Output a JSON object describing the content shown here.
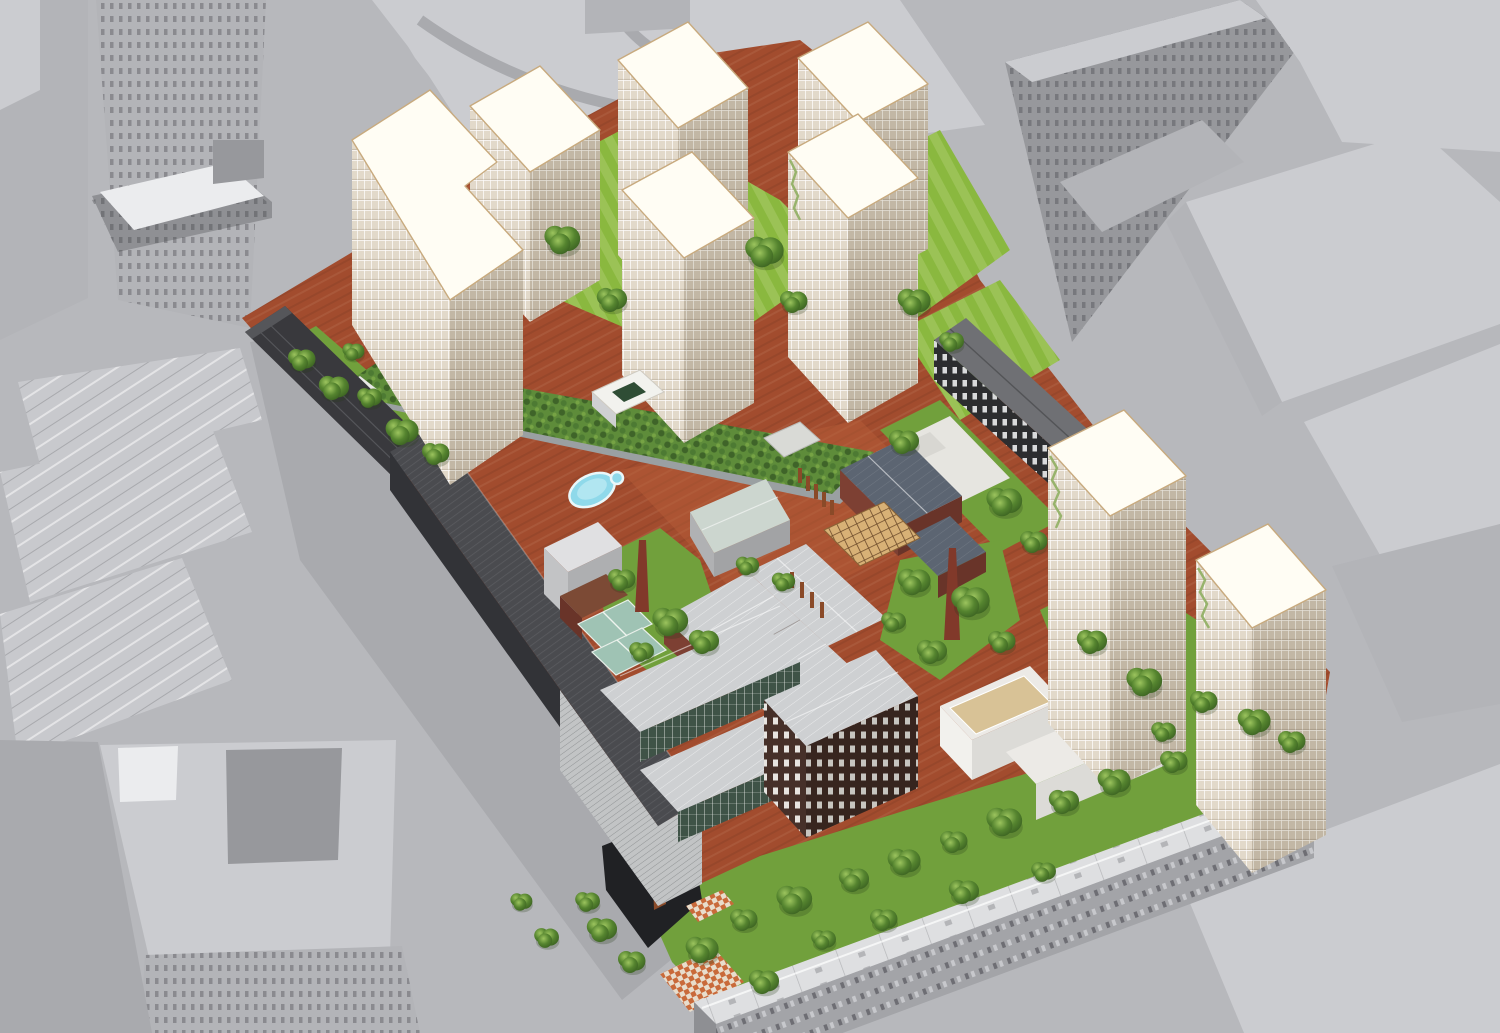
{
  "scene": {
    "type": "architectural-aerial-rendering",
    "title": "Bird's-eye 3D visualization of an urban block redevelopment masterplan",
    "description": "Perspective aerial render of a former industrial block transformed into a mixed-use quarter: seven cream residential towers with glowing white roofs on the north side, two cream towers on the east, red clay ground plane, linear green roof with kidney-shaped pool, preserved brick factory halls with two slender brick chimneys, a timber pergola court, long charcoal bar buildings on the west and north-east edges, a dark perforated cube, white terraced courtyard building, dense tree gardens, and an existing gray perimeter housing row on the south. Surrounding city context is rendered as flat monochrome gray massing with streets.",
    "counts": {
      "towers_north_cluster": 7,
      "towers_east_pair": 2,
      "brick_chimneys": 2,
      "dark_bar_buildings": 3,
      "pools": 1
    },
    "palette": {
      "bg_street": "#b7b8bc",
      "street_dark": "#a9aaae",
      "context_block_light": "#cbccd0",
      "context_block_mid": "#b3b4b8",
      "context_block_dark": "#97989c",
      "context_roof_white": "#ebecee",
      "context_facade": "#8f9094",
      "site_clay": "#a24c2e",
      "site_clay_light": "#b85f3a",
      "lawn_green": "#8ab83f",
      "garden_green": "#71a03c",
      "podium_green": "#5e8c3a",
      "podium_wall": "#9aa0a2",
      "hedge_dark": "#3f6429",
      "pool_blue": "#8fd9ea",
      "pool_rim": "#eaf7f9",
      "tower_face_light": "#e2d9ca",
      "tower_face_shade": "#c2b7a5",
      "tower_roof": "#fffdf4",
      "tower_trim": "#c8aa7e",
      "balcony_green": "#8fae62",
      "dark_shed": "#39393d",
      "dark_bar_roof": "#4a4b4f",
      "dark_bar_face": "#323337",
      "black_bldg_face": "#2c2d2f",
      "black_bldg_roof": "#6f7074",
      "brown_bldg_face": "#463029",
      "brick_red": "#7d4033",
      "slate_roof": "#5c6572",
      "silver_roof": "#ced0d2",
      "pale_roof": "#e6e5e0",
      "manor_roof": "#ccd6cf",
      "rust_roof": "#7c4a35",
      "glass_green": "#3f5347",
      "greenhouse_glass": "#9fc3b4",
      "corten": "#8a4a28",
      "chimney_red": "#81392a",
      "pergola_tan": "#d8b176",
      "deck_tan": "#d8c296",
      "checker_orange": "#c96a3a",
      "checker_cream": "#e8ddcc",
      "housing_roof": "#dedfe1",
      "housing_face": "#a3a4a8",
      "sunken_dark": "#202124",
      "tree_green_dark": "#3c6322",
      "tree_green_mid": "#55842f",
      "tree_green_light": "#9cc45e"
    },
    "elements": [
      {
        "name": "context-city-blocks",
        "description": "Flat gray massing of surrounding streets and buildings on all four sides"
      },
      {
        "name": "site-clay-ground",
        "description": "Red-brown clay brick ground plane of the development site"
      },
      {
        "name": "north-tower-cluster",
        "description": "Seven cream grid-facade towers with bright white roofs standing in lawns"
      },
      {
        "name": "east-tower-pair",
        "description": "Two cream towers with white roofs along the eastern street"
      },
      {
        "name": "green-roof-podium",
        "description": "Long planted roof with hedges and a kidney-shaped swimming pool"
      },
      {
        "name": "west-dark-bar",
        "description": "Long charcoal bar building with striped roof along the west edge"
      },
      {
        "name": "northwest-black-shed",
        "description": "Black gabled shed at the north-west corner"
      },
      {
        "name": "northeast-black-bar",
        "description": "Black bar with white window grid and gray roof on the north-east edge"
      },
      {
        "name": "factory-complex",
        "description": "Preserved brick factory wings with light gray gabled roofs"
      },
      {
        "name": "manor-house",
        "description": "Gray historic house with pale green hipped roof"
      },
      {
        "name": "white-roof-hall",
        "description": "Large hall with white roof and brick slate-roofed wing"
      },
      {
        "name": "brick-chimneys",
        "description": "Two slender red-brick industrial chimneys in tree gardens"
      },
      {
        "name": "pergola-court",
        "description": "Timber lattice pergola over a courtyard"
      },
      {
        "name": "corten-posts",
        "description": "Rows of weathered-steel posts on the plaza"
      },
      {
        "name": "greenhouse-pavilion",
        "description": "Green glass winter-garden pavilion"
      },
      {
        "name": "glass-halls",
        "description": "Two long halls with silver roofs and dark green glazed facades"
      },
      {
        "name": "dark-cube-building",
        "description": "Dark brown building with regular white windows and silver gable roof"
      },
      {
        "name": "terrace-building",
        "description": "White L-shaped building with tan rooftop decks"
      },
      {
        "name": "south-garden",
        "description": "Dense tree garden band along the southern housing"
      },
      {
        "name": "perimeter-housing",
        "description": "Existing long gray housing row with white pitched roof on the south edge"
      },
      {
        "name": "sunken-plaza",
        "description": "Dark sunken court with a corten tower at the south-west"
      },
      {
        "name": "checker-paving",
        "description": "Orange and cream checkered paving patches"
      }
    ]
  }
}
